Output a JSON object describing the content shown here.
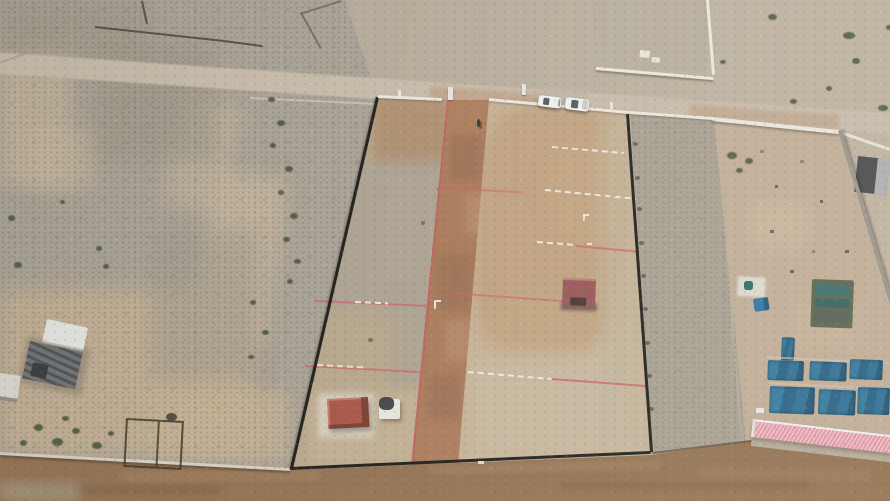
{
  "scene": {
    "title": "Aerial drone photo - desert land plots",
    "description": "Aerial drone photograph of a desert land subdivision: a black-fenced rectangular plot with a red graded dirt road, pink surveyor lines and white lot markers, two parked white cars at the entrance, small red-roof huts, a gravel buffer strip, a neighboring farm compound with blue shade-net pens and a pink corrugated roof building, rocky terrain with shrubs, walled compounds and a brown dirt road along the bottom.",
    "objects": [
      "rocky desert terrain",
      "sand wash with shrubs",
      "diagonal access road",
      "walled compounds",
      "subdivided plot under development",
      "black mesh fencing",
      "white boundary wall with posts",
      "red graded dirt road",
      "pink surveyor boundary lines",
      "white lot marker lines",
      "maroon-roof hut",
      "red-roof hut",
      "white storage shed",
      "two parked white cars",
      "person on dirt road",
      "gravel buffer strip",
      "farm compound with blue shade-net pens",
      "pink corrugated roof building",
      "gray boundary wall",
      "truck and sheds",
      "building foundation outline",
      "green shrubs",
      "bottom dirt road"
    ],
    "counts": {
      "cars": 2,
      "huts": 3,
      "blue_tarps": 7,
      "people": 1
    }
  },
  "palette": {
    "desertBase": "#b6ac9b",
    "rockyGray": "#a9a296",
    "sandLight": "#c4b59c",
    "sandBottom": "#c3b094",
    "plotLeft": "#b7a78d",
    "plotRight": "#c6b197",
    "gradedBrown": "#bfa17f",
    "accessRoad": "#c6bbaa",
    "dirtRedA": "#b28264",
    "dirtRedB": "#a87a5a",
    "broadA": "#8a6a4e",
    "broadB": "#9d7d5d",
    "fenceDark": "#24221f",
    "wallWhite": "#e9e6dd",
    "wallGray": "#9b968b",
    "pinkStripe": "#e09aa8",
    "pinkStripeLight": "#f2cdd4",
    "pinkLine": "#cc646a",
    "blueTarpA": "#357a9e",
    "blueTarpB": "#275a7a",
    "tealShade": "#2e6e68",
    "redRoofSmall": "#a85848",
    "redRoofMaroon": "#99575a",
    "structWhite": "#e6e4dc",
    "carWhite": "#eef0ee",
    "bushGreen": "#47563c",
    "truckGray": "#707476",
    "gravelStrip": "#a8a193",
    "farmSand": "#c0ad97"
  }
}
